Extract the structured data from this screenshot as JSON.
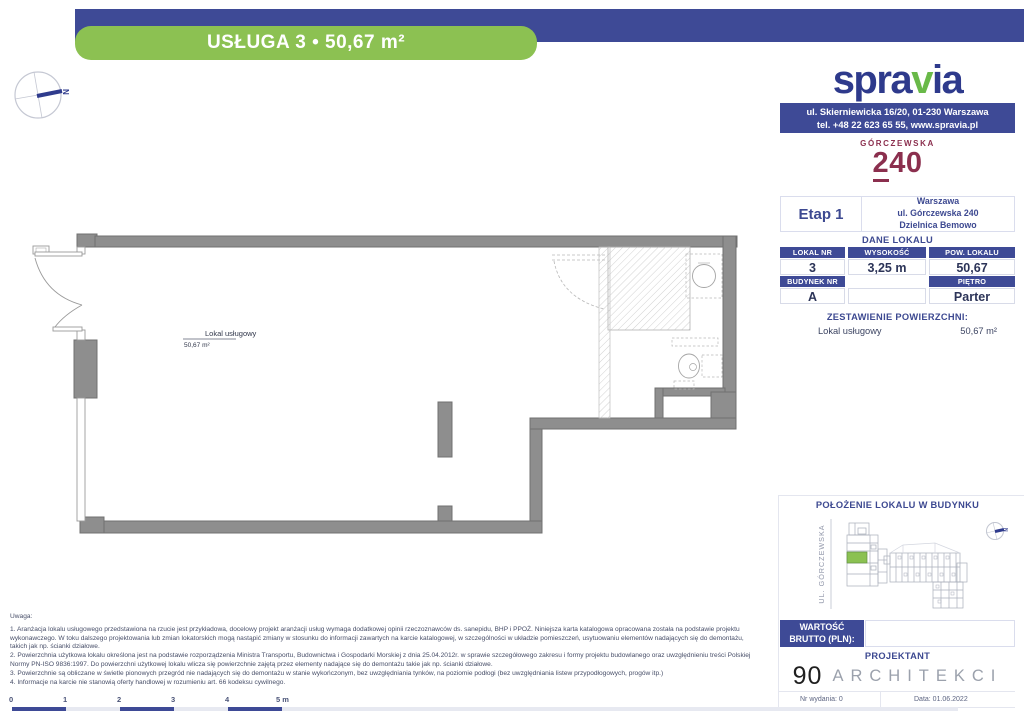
{
  "banner": {
    "text": "USŁUGA 3 • 50,67 m²"
  },
  "brand": {
    "logo_part1": "spra",
    "logo_part2": "v",
    "logo_part3": "ia",
    "address_line1": "ul. Skierniewicka 16/20, 01-230 Warszawa",
    "address_line2": "tel. +48 22 623 65 55, www.spravia.pl"
  },
  "project": {
    "logo_name": "GÓRCZEWSKA",
    "logo_number_part1": "2",
    "logo_number_part2": "40",
    "stage": "Etap 1",
    "city": "Warszawa",
    "street": "ul. Górczewska 240",
    "district": "Dzielnica Bemowo"
  },
  "unit_table": {
    "title": "DANE LOKALU",
    "headers_top": [
      "LOKAL NR",
      "WYSOKOŚĆ",
      "POW. LOKALU"
    ],
    "values_top": [
      "3",
      "3,25 m",
      "50,67"
    ],
    "headers_bottom": [
      "BUDYNEK NR",
      "",
      "PIĘTRO"
    ],
    "values_bottom": [
      "A",
      "",
      "Parter"
    ]
  },
  "area_summary": {
    "title": "ZESTAWIENIE POWIERZCHNI:",
    "row_name": "Lokal usługowy",
    "row_value": "50,67 m²"
  },
  "floor_plan": {
    "room_label": "Lokal usługowy",
    "room_area": "50,67 m²",
    "compass_letter": "N"
  },
  "location": {
    "title": "POŁOŻENIE LOKALU W BUDYNKU",
    "street_label": "UL. GÓRCZEWSKA",
    "compass_letter": "N"
  },
  "price": {
    "label_line1": "WARTOŚĆ",
    "label_line2": "BRUTTO (PLN):",
    "value": ""
  },
  "designer": {
    "title": "PROJEKTANT",
    "logo_number": "90",
    "logo_text": "ARCHITEKCI"
  },
  "issue": {
    "number": "Nr wydania: 0",
    "date": "Data: 01.06.2022"
  },
  "notes": {
    "lines": [
      "Uwaga:",
      "1. Aranżacja lokalu usługowego przedstawiona na rzucie jest przykładowa, docelowy projekt aranżacji usług wymaga dodatkowej opinii rzeczoznawców ds. sanepidu, BHP i PPOŻ. Niniejsza karta katalogowa opracowana została na podstawie projektu",
      "wykonawczego. W toku dalszego projektowania lub zmian lokatorskich mogą nastąpić zmiany w stosunku do informacji zawartych na karcie katalogowej, w szczególności w układzie pomieszczeń, usytuowaniu elementów nadających się do demontażu,",
      "takich jak np. ścianki działowe.",
      "2. Powierzchnia użytkowa lokalu określona jest na podstawie rozporządzenia Ministra Transportu, Budownictwa i Gospodarki Morskiej z dnia 25.04.2012r. w sprawie szczegółowego zakresu i formy projektu budowlanego oraz uwzględnieniu treści Polskiej",
      "Normy PN-ISO 9836:1997. Do powierzchni użytkowej lokalu wlicza się powierzchnie zajętą przez elementy nadające się do demontażu takie jak np. ścianki działowe.",
      "3. Powierzchnie są obliczane w świetle pionowych przegród nie nadających się do demontażu w stanie wykończonym, bez uwzględniania tynków, na poziomie podłogi (bez uwzględniania listew przypodłogowych, progów itp.)",
      "4. Informacje na karcie nie stanowią oferty handlowej w rozumieniu art. 66 kodeksu cywilnego."
    ]
  },
  "scale_bar": {
    "labels": [
      "0",
      "1",
      "2",
      "3",
      "4",
      "5 m"
    ]
  },
  "colors": {
    "navy": "#3e4a96",
    "green": "#8cc152",
    "maroon": "#8b2f4e",
    "wall_gray": "#8e8e8e",
    "unit_highlight": "#8bc152"
  }
}
